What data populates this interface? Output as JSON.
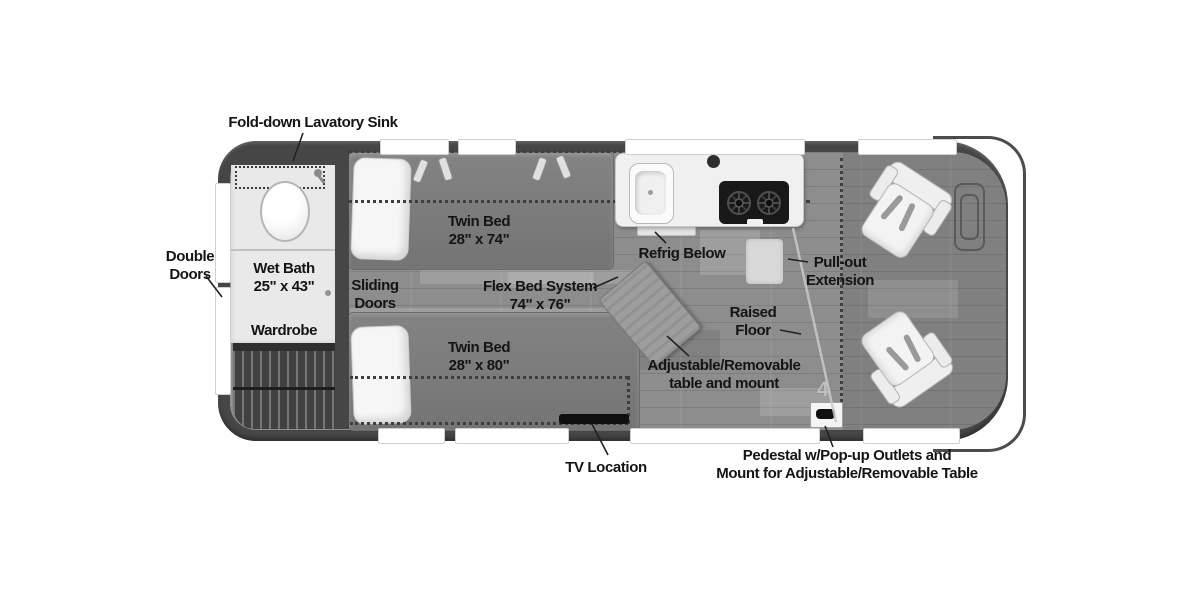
{
  "diagram_type": "rv-floor-plan",
  "labels": {
    "lavatory_sink": "Fold-down Lavatory Sink",
    "double_doors": {
      "line1": "Double",
      "line2": "Doors"
    },
    "wet_bath": {
      "line1": "Wet Bath",
      "line2": "25\" x 43\""
    },
    "wardrobe": "Wardrobe",
    "sliding_doors": {
      "line1": "Sliding",
      "line2": "Doors"
    },
    "twin_bed_top": {
      "line1": "Twin Bed",
      "line2": "28\" x 74\""
    },
    "flex_bed": {
      "line1": "Flex Bed System",
      "line2": "74\" x 76\""
    },
    "refrig": "Refrig Below",
    "pull_out": {
      "line1": "Pull-out",
      "line2": "Extension"
    },
    "raised_floor": {
      "line1": "Raised",
      "line2": "Floor"
    },
    "table": {
      "line1": "Adjustable/Removable",
      "line2": "table and mount"
    },
    "twin_bed_bottom": {
      "line1": "Twin Bed",
      "line2": "28\" x 80\""
    },
    "tv": "TV Location",
    "pedestal": {
      "line1": "Pedestal w/Pop-up Outlets and",
      "line2": "Mount for Adjustable/Removable Table"
    },
    "pedestal_mount_glyph": "4"
  },
  "colors": {
    "wall": "#464646",
    "floor": "#8d8d8d",
    "bath": "#e9e9e9",
    "wardrobe": "#414141",
    "mattress": "#7a7a7a",
    "counter": "#f0f0f0",
    "stove": "#181818",
    "seat": "#f1f1f1",
    "table": "#9d9d9d",
    "tv": "#0f0f0f",
    "window": "#ffffff",
    "label_text": "#141414"
  }
}
